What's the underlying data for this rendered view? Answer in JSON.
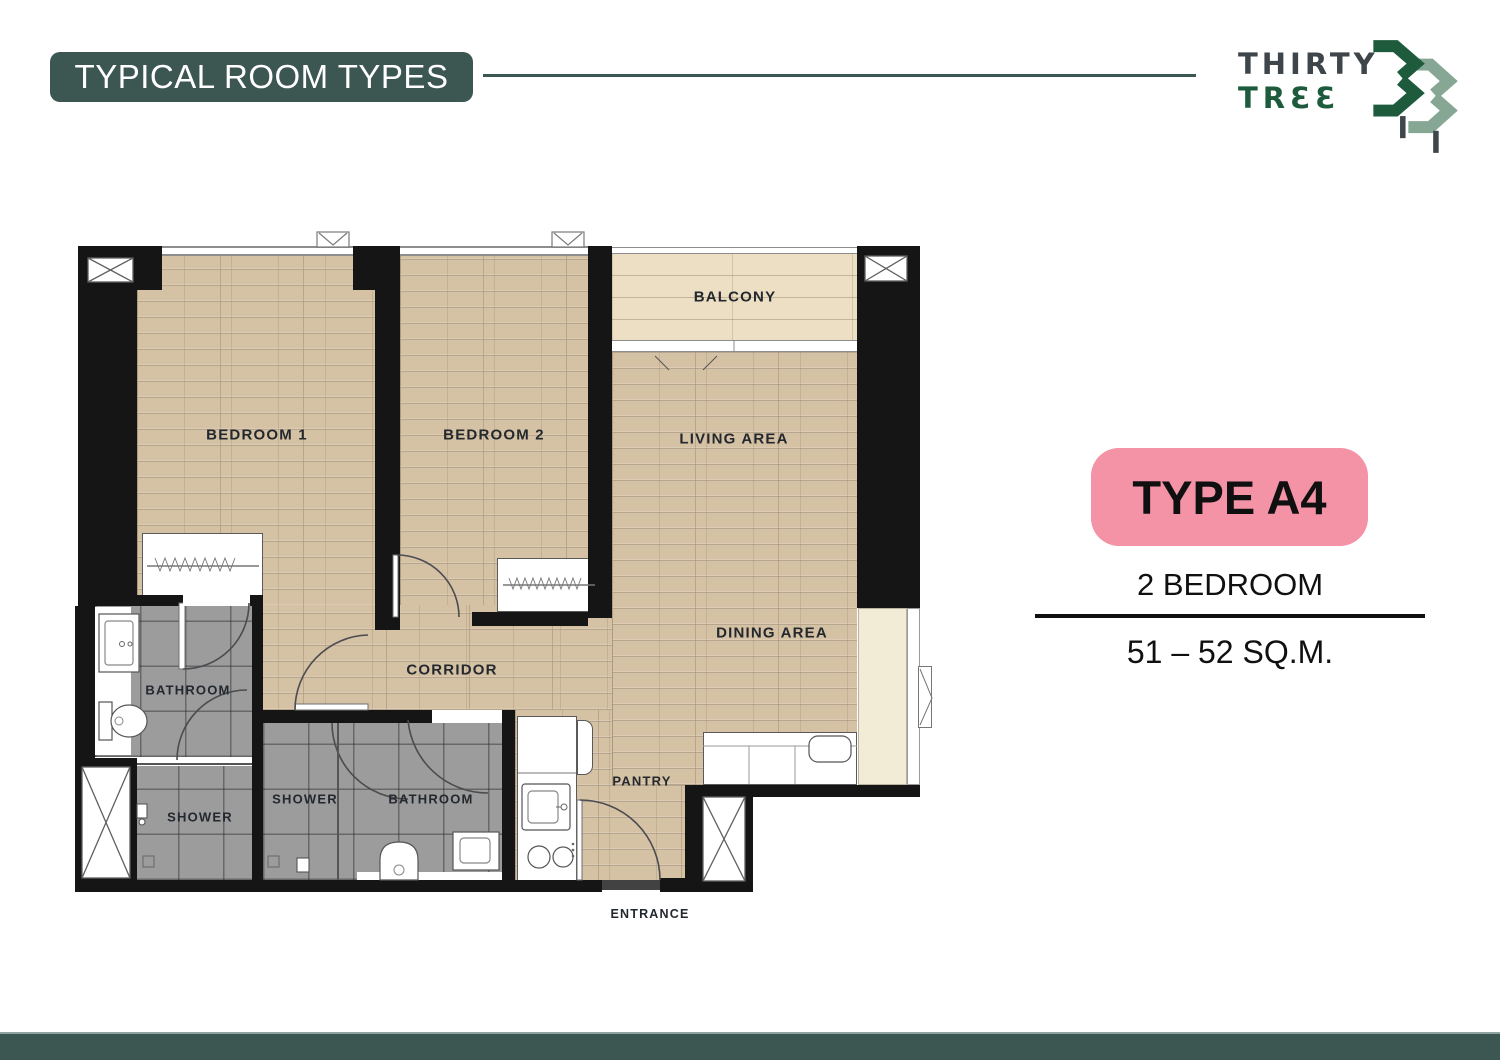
{
  "header": {
    "title": "TYPICAL ROOM TYPES"
  },
  "brand": {
    "name_line1": "THIRTY",
    "name_line2": "TRƐƐ",
    "mark": "33-trees-logo"
  },
  "unit": {
    "type": "TYPE A4",
    "bedrooms": "2 BEDROOM",
    "area": "51 – 52 SQ.M."
  },
  "plan": {
    "rooms": {
      "bedroom1": "BEDROOM 1",
      "bedroom2": "BEDROOM 2",
      "living": "LIVING AREA",
      "dining": "DINING AREA",
      "balcony": "BALCONY",
      "corridor": "CORRIDOR",
      "bathroom1": "BATHROOM",
      "shower1": "SHOWER",
      "shower2": "SHOWER",
      "bathroom2": "BATHROOM",
      "pantry": "PANTRY"
    },
    "entrance": "ENTRANCE"
  },
  "colors": {
    "teal": "#3C5652",
    "pink": "#F492A6",
    "logo_green": "#1E5B3D",
    "logo_sage": "#86A794",
    "logo_gray": "#3F464B",
    "wall": "#151515",
    "wood": "#D5C1A3",
    "balcony_wood": "#ECDFC4",
    "tile_gray": "#9C9C9C",
    "cabinet_beige": "#F2ECD7"
  }
}
